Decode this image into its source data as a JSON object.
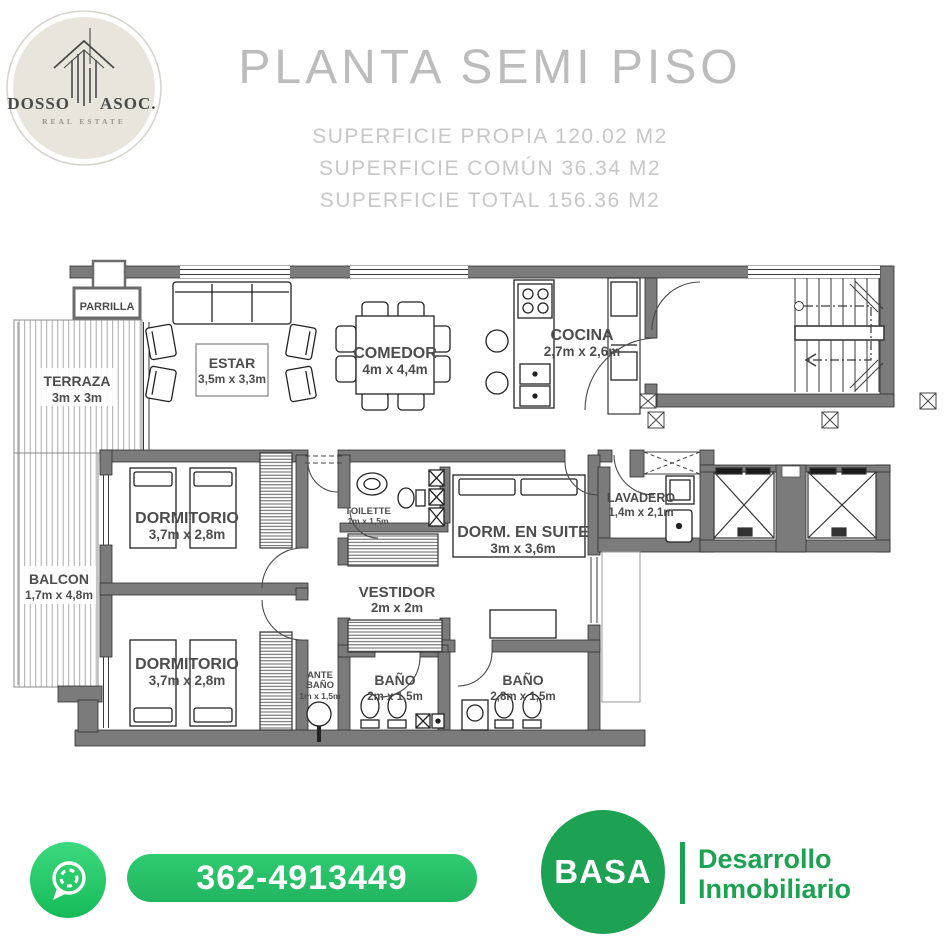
{
  "brand": {
    "name_left": "DOSSO",
    "name_right": "ASOC.",
    "tagline": "REAL ESTATE"
  },
  "header": {
    "title": "PLANTA SEMI PISO",
    "surface_lines": [
      "SUPERFICIE PROPIA 120.02 M2",
      "SUPERFICIE COMÚN 36.34 M2",
      "SUPERFICIE TOTAL 156.36 M2"
    ]
  },
  "floorplan": {
    "rooms": {
      "parrilla": {
        "name": "PARRILLA"
      },
      "terraza": {
        "name": "TERRAZA",
        "dims": "3m x 3m"
      },
      "estar": {
        "name": "ESTAR",
        "dims": "3,5m x 3,3m"
      },
      "comedor": {
        "name": "COMEDOR",
        "dims": "4m x 4,4m"
      },
      "cocina": {
        "name": "COCINA",
        "dims": "2,7m x 2,6m"
      },
      "balcon": {
        "name": "BALCON",
        "dims": "1,7m x 4,8m"
      },
      "dormitorio_1": {
        "name": "DORMITORIO",
        "dims": "3,7m x 2,8m"
      },
      "toilette": {
        "name": "TOILETTE",
        "dims": "1m x 1,5m"
      },
      "dorm_en_suite": {
        "name": "DORM. EN SUITE",
        "dims": "3m x 3,6m"
      },
      "vestidor": {
        "name": "VESTIDOR",
        "dims": "2m x 2m"
      },
      "lavadero": {
        "name": "LAVADERO",
        "dims": "1,4m x 2,1m"
      },
      "dormitorio_2": {
        "name": "DORMITORIO",
        "dims": "3,7m x 2,8m"
      },
      "ante_bano": {
        "name_line1": "ANTE",
        "name_line2": "BAÑO",
        "dims": "1m x 1,5m"
      },
      "bano_1": {
        "name": "BAÑO",
        "dims": "2m x 1,5m"
      },
      "bano_2": {
        "name": "BAÑO",
        "dims": "2,8m x 1,5m"
      }
    }
  },
  "footer": {
    "phone": "362-4913449",
    "developer_name": "BASA",
    "developer_tagline_line1": "Desarrollo",
    "developer_tagline_line2": "Inmobiliario"
  },
  "colors": {
    "whatsapp_green": "#2bd36e",
    "pill_green": "#27c468",
    "basa_green": "#1da152",
    "wall_gray": "#7b7b7b",
    "label_gray": "#4d4d4d",
    "title_gray": "#bcbcbc",
    "logo_beige": "#e9e5dc"
  }
}
